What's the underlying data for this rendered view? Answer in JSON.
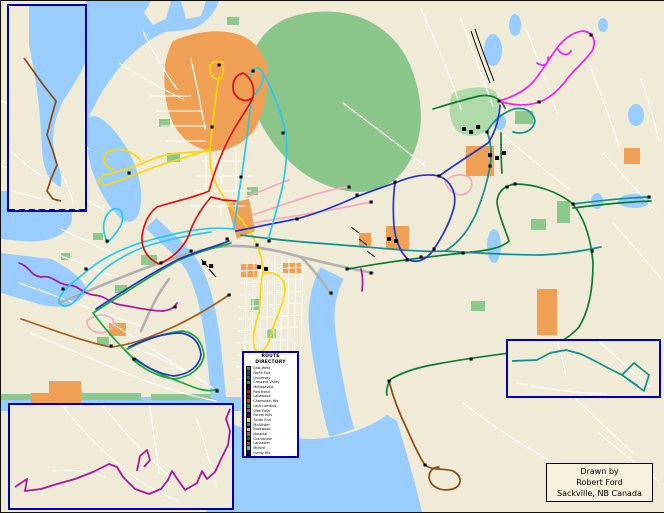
{
  "colors": {
    "water": "#99CCFF",
    "land": "#F0EBD6",
    "road": "#FFFFFF",
    "highway": "#B5B5B5",
    "park": "#8CC98C",
    "park_light": "#AEDBA8",
    "forest": "#8AC58A",
    "zone_orange": "#F0A055",
    "inset_border": "#0000AA",
    "rail": "#000000",
    "stop": "#000000",
    "route_red": "#E01010",
    "route_yellow": "#FFD800",
    "route_cyan": "#29C8F0",
    "route_blue": "#2038C8",
    "route_green": "#18A83C",
    "route_dark_green": "#0E7C30",
    "route_teal": "#0F8F8F",
    "route_magenta": "#F020F0",
    "route_purple": "#A8189C",
    "route_pink": "#F4A9BE",
    "route_brown": "#A65C1F",
    "route_brown_dark": "#8C4A12",
    "route_gray": "#B0B0B0"
  },
  "legend": {
    "title": "ROUTE DIRECTORY",
    "entries": [
      {
        "label": "East-West",
        "color": "#18A83C"
      },
      {
        "label": "North End",
        "color": "#2038C8"
      },
      {
        "label": "University",
        "color": "#0E7C30"
      },
      {
        "label": "Crescent Valley",
        "color": "#18A83C"
      },
      {
        "label": "Millidgeville",
        "color": "#000080"
      },
      {
        "label": "Red Head",
        "color": "#E01010"
      },
      {
        "label": "Lakewood",
        "color": "#A11212"
      },
      {
        "label": "Champlain Hts",
        "color": "#C84A10"
      },
      {
        "label": "Loch Lomond",
        "color": "#0F8F8F"
      },
      {
        "label": "Glen Falls",
        "color": "#F020F0"
      },
      {
        "label": "Forest Hills",
        "color": "#3A1070"
      },
      {
        "label": "South End",
        "color": "#FFD800"
      },
      {
        "label": "McAllister",
        "color": "#149C9C"
      },
      {
        "label": "Rockwood",
        "color": "#F4A9BE"
      },
      {
        "label": "Hospital",
        "color": "#707070"
      },
      {
        "label": "Grandview",
        "color": "#0E7C30"
      },
      {
        "label": "Lancaster",
        "color": "#A65C1F"
      },
      {
        "label": "Milford",
        "color": "#29C8F0"
      },
      {
        "label": "Fundy Hts",
        "color": "#000080"
      },
      {
        "label": "Spruce Lake",
        "color": "#181818"
      }
    ]
  },
  "attribution": {
    "line1": "Drawn by",
    "line2": "Robert Ford",
    "line3": "Sackville, NB Canada"
  }
}
